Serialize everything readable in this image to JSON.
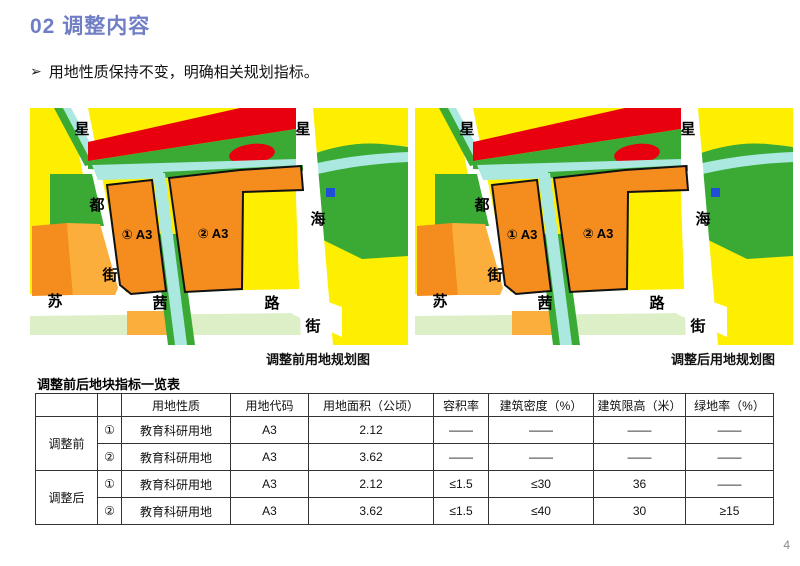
{
  "slide": {
    "title": "02 调整内容",
    "bullet_marker": "➢",
    "bullet_text": "用地性质保持不变，明确相关规划指标。",
    "page_number": "4"
  },
  "maps": {
    "before_caption": "调整前用地规划图",
    "after_caption": "调整后用地规划图",
    "labels": {
      "road_w_1": "星",
      "road_w_2": "都",
      "road_w_3": "街",
      "road_e_1": "星",
      "road_e_2": "海",
      "road_s_1": "苏",
      "road_s_2": "茜",
      "road_s_3": "路",
      "road_s_4": "街",
      "parcel_1": "① A3",
      "parcel_2": "② A3"
    }
  },
  "table": {
    "title": "调整前后地块指标一览表",
    "headers": [
      "",
      "",
      "用地性质",
      "用地代码",
      "用地面积（公顷）",
      "容积率",
      "建筑密度（%）",
      "建筑限高（米）",
      "绿地率（%）"
    ],
    "row_groups": [
      {
        "label": "调整前",
        "rows": [
          {
            "no": "①",
            "use": "教育科研用地",
            "code": "A3",
            "area": "2.12",
            "far": "——",
            "density": "——",
            "height": "——",
            "green": "——"
          },
          {
            "no": "②",
            "use": "教育科研用地",
            "code": "A3",
            "area": "3.62",
            "far": "——",
            "density": "——",
            "height": "——",
            "green": "——"
          }
        ]
      },
      {
        "label": "调整后",
        "rows": [
          {
            "no": "①",
            "use": "教育科研用地",
            "code": "A3",
            "area": "2.12",
            "far": "≤1.5",
            "density": "≤30",
            "height": "36",
            "green": "——"
          },
          {
            "no": "②",
            "use": "教育科研用地",
            "code": "A3",
            "area": "3.62",
            "far": "≤1.5",
            "density": "≤40",
            "height": "30",
            "green": "≥15"
          }
        ]
      }
    ]
  },
  "colors": {
    "title_blue": "#6f7ec5",
    "map_yellow": "#feee00",
    "map_orange_parcel": "#f48c1e",
    "map_orange_light": "#fbae3c",
    "map_green": "#3aaa35",
    "map_pale_green": "#dcefc6",
    "map_cyan_water": "#aae8e0",
    "map_red": "#e8000f",
    "map_blue_square": "#1f4fd8",
    "road_white": "#ffffff",
    "parcel_outline": "#111111"
  }
}
